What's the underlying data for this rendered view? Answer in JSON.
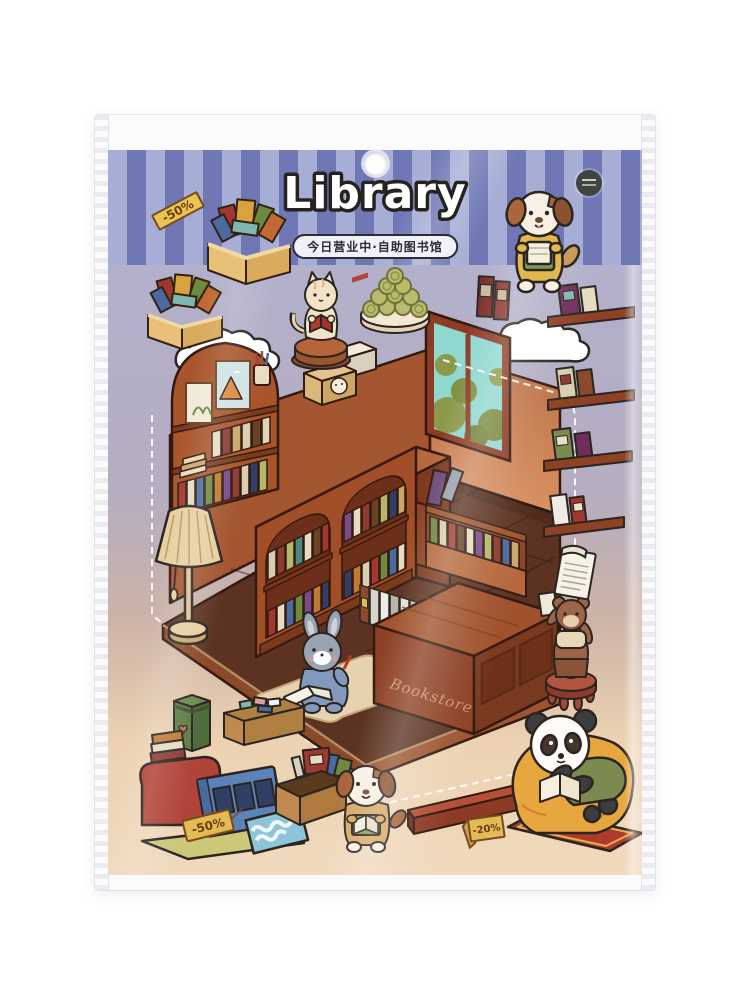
{
  "header": {
    "title": "Library",
    "subtitle": "今日营业中·自助图书馆",
    "discount_tag": "-50%"
  },
  "sheet": {
    "counter_sign": "Bookstore",
    "clearance_tag": "-50%",
    "floor_tag": "-20%",
    "stickers": [
      "crate-of-books",
      "cloud",
      "cat-reading-on-stool",
      "plate-of-cookies",
      "standing-books",
      "wall-shelf-books",
      "library-room",
      "arched-bookshelf",
      "window-with-bushes",
      "double-bookcase",
      "floor-lamp",
      "console-shelf",
      "floor-book-row",
      "rug",
      "bunny-writing",
      "bookstore-counter",
      "bear-on-stool",
      "green-box",
      "stationery-box",
      "clearance-pile",
      "puppy-reading",
      "wooden-plank",
      "panda-on-beanbag",
      "paper-scroll"
    ]
  },
  "colors": {
    "stripe_light": "#a6aed6",
    "stripe_dark": "#6f78b5",
    "tag_yellow": "#e8c455",
    "wall_left": "#a3562f",
    "wall_right": "#c4764a",
    "floor": "#5c3322",
    "window_glass": "#8fd8d0",
    "sheet_top": "#b2b0cb",
    "sheet_bottom": "#f0d9bd"
  }
}
